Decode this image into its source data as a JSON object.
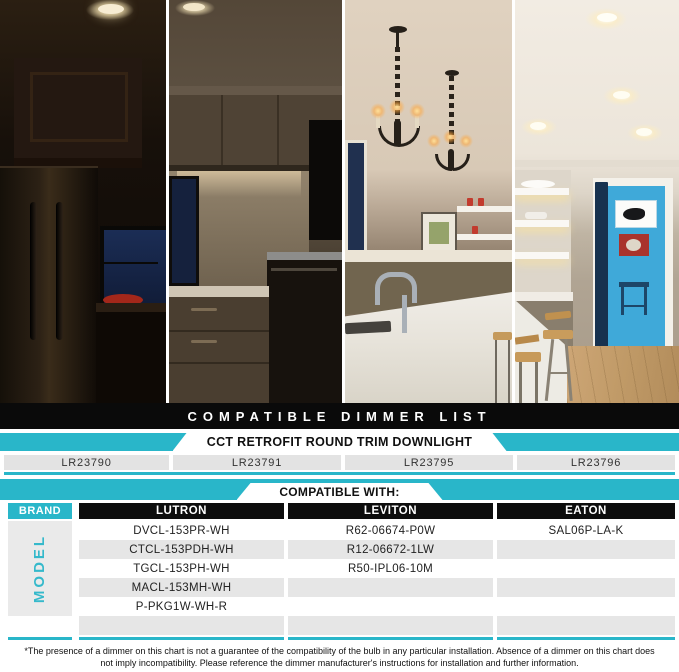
{
  "banner": {
    "title": "COMPATIBLE DIMMER LIST"
  },
  "product": {
    "name": "CCT RETROFIT ROUND TRIM DOWNLIGHT",
    "models": [
      "LR23790",
      "LR23791",
      "LR23795",
      "LR23796"
    ]
  },
  "table": {
    "heading": "COMPATIBLE WITH:",
    "brand_label": "BRAND",
    "model_label": "MODEL",
    "brands": [
      "LUTRON",
      "LEVITON",
      "EATON"
    ],
    "rows": [
      [
        "DVCL-153PR-WH",
        "R62-06674-P0W",
        "SAL06P-LA-K"
      ],
      [
        "CTCL-153PDH-WH",
        "R12-06672-1LW",
        ""
      ],
      [
        "TGCL-153PH-WH",
        "R50-IPL06-10M",
        ""
      ],
      [
        "MACL-153MH-WH",
        "",
        ""
      ],
      [
        "P-PKG1W-WH-R",
        "",
        ""
      ],
      [
        "",
        "",
        ""
      ]
    ]
  },
  "footnote": "*The presence of a dimmer on this chart is not a guarantee of the compatibility of the bulb in any particular installation. Absence of a dimmer on this chart does not imply incompatibility. Please reference the dimmer manufacturer's instructions for installation and further information.",
  "colors": {
    "accent_teal": "#29b6c9",
    "row_alt": "#e6e6e6",
    "banner_black": "#0a0a0a"
  },
  "photo": {
    "description": "Kitchen scene shown in four vertical slices at increasing dimmer brightness levels"
  },
  "chart_data": {
    "type": "table",
    "title": "COMPATIBLE DIMMER LIST",
    "subtitle": "CCT RETROFIT ROUND TRIM DOWNLIGHT",
    "product_models": [
      "LR23790",
      "LR23791",
      "LR23795",
      "LR23796"
    ],
    "columns": [
      "BRAND",
      "LUTRON",
      "LEVITON",
      "EATON"
    ],
    "rows": [
      [
        "DVCL-153PR-WH",
        "R62-06674-P0W",
        "SAL06P-LA-K"
      ],
      [
        "CTCL-153PDH-WH",
        "R12-06672-1LW",
        ""
      ],
      [
        "TGCL-153PH-WH",
        "R50-IPL06-10M",
        ""
      ],
      [
        "MACL-153MH-WH",
        "",
        ""
      ],
      [
        "P-PKG1W-WH-R",
        "",
        ""
      ]
    ]
  }
}
